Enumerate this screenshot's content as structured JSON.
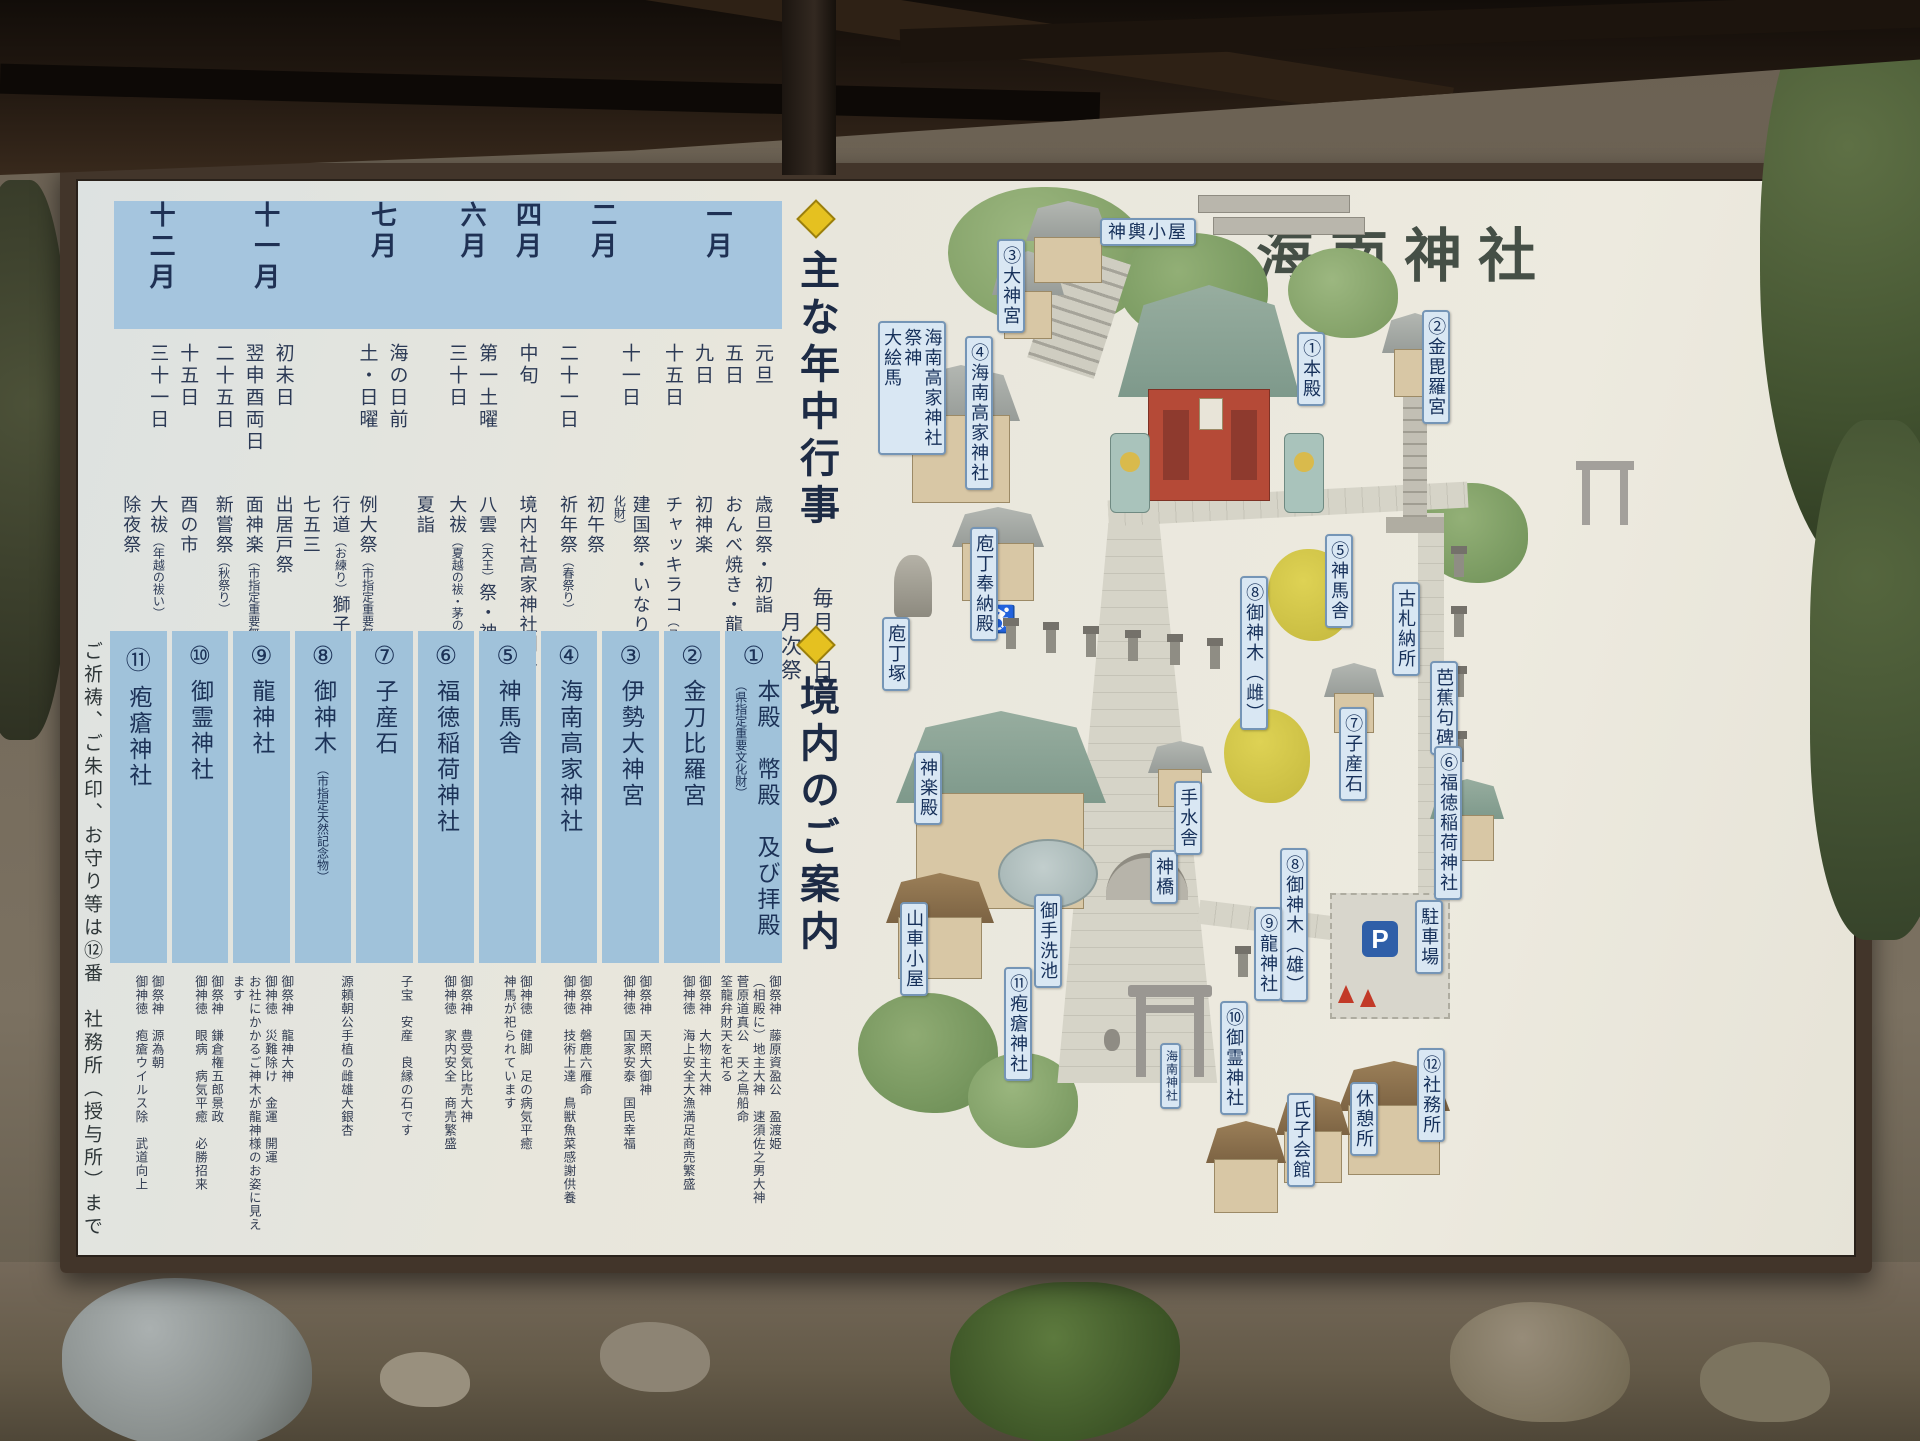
{
  "board": {
    "title": "海南神社",
    "events_section": {
      "header": "主な年中行事",
      "subheader": "毎月一日\n　月次祭",
      "months": [
        {
          "month": "一月",
          "entries": [
            {
              "date": "元旦",
              "event": "歳旦祭・初詣"
            },
            {
              "date": "五日",
              "event": "おんべ焼き・龍宮祭"
            },
            {
              "date": "九日",
              "event": "初神楽"
            },
            {
              "date": "十五日",
              "event": "チャッキラコ（ユネスコ無形文化遺産）"
            }
          ]
        },
        {
          "month": "二月",
          "entries": [
            {
              "date": "十一日",
              "event": "建国祭・いなりっこ（市指定重要無形民俗文化財）"
            },
            {
              "date": "",
              "event": "初午祭"
            },
            {
              "date": "二十一日",
              "event": "祈年祭（春祭り）"
            }
          ]
        },
        {
          "month": "四月",
          "entries": [
            {
              "date": "中旬",
              "event": "境内社高家神社例祭（食の神祭典・庖丁式）"
            }
          ]
        },
        {
          "month": "六月",
          "entries": [
            {
              "date": "第一土曜",
              "event": "八雲（天王）祭・神輿渡御"
            },
            {
              "date": "三十日",
              "event": "大祓（夏越の祓・茅の輪くぐり）"
            }
          ]
        },
        {
          "month": "七月",
          "entries": [
            {
              "date": "",
              "event": "夏詣"
            },
            {
              "date": "海の日前",
              "event": ""
            },
            {
              "date": "土・日曜",
              "event": "例大祭（市指定重要無形民俗文化財）"
            },
            {
              "date": "",
              "event": "行道（お練り）獅子・神輿渡御"
            }
          ]
        },
        {
          "month": "十一月",
          "entries": [
            {
              "date": "",
              "event": "七五三"
            },
            {
              "date": "初未日",
              "event": "出居戸祭"
            },
            {
              "date": "翌申酉両日",
              "event": "面神楽（市指定重要無形民俗文化財）"
            },
            {
              "date": "二十五日",
              "event": "新嘗祭（秋祭り）"
            }
          ]
        },
        {
          "month": "十二月",
          "entries": [
            {
              "date": "十五日",
              "event": "酉の市"
            },
            {
              "date": "三十一日",
              "event": "大祓（年越の祓い）"
            },
            {
              "date": "",
              "event": "除夜祭"
            }
          ]
        }
      ]
    },
    "guide_section": {
      "header": "境内のご案内",
      "spots": [
        {
          "no": "①",
          "name": "本殿　幣殿　及び拝殿",
          "note": "（県指定重要文化財）",
          "desc": "御祭神　藤原資盈公　盈渡姫\n（相殿に）地主大神　速須佐之男大神\n菅原道真公　天之鳥船命\n筌龍弁財天を祀る"
        },
        {
          "no": "②",
          "name": "金刀比羅宮",
          "note": "",
          "desc": "御祭神　大物主大神\n御神徳　海上安全大漁満足商売繁盛"
        },
        {
          "no": "③",
          "name": "伊勢大神宮",
          "note": "",
          "desc": "御祭神　天照大御神\n御神徳　国家安泰　国民幸福"
        },
        {
          "no": "④",
          "name": "海南高家神社",
          "note": "",
          "desc": "御祭神　磐鹿六雁命\n御神徳　技術上達　鳥獣魚菜感謝供養"
        },
        {
          "no": "⑤",
          "name": "神馬舎",
          "note": "",
          "desc": "御神徳　健脚　足の病気平癒\n神馬が祀られています"
        },
        {
          "no": "⑥",
          "name": "福徳稲荷神社",
          "note": "",
          "desc": "御祭神　豊受気比売大神\n御神徳　家内安全　商売繁盛"
        },
        {
          "no": "⑦",
          "name": "子産石",
          "note": "",
          "desc": "子宝　安産　良縁の石です"
        },
        {
          "no": "⑧",
          "name": "御神木",
          "note": "（市指定天然記念物）",
          "desc": "源頼朝公手植の雌雄大銀杏"
        },
        {
          "no": "⑨",
          "name": "龍神社",
          "note": "",
          "desc": "御祭神　龍神大神\n御神徳　災難除け　金運　開運\nお社にかかるご神木が龍神様のお姿に見えます"
        },
        {
          "no": "⑩",
          "name": "御霊神社",
          "note": "",
          "desc": "御祭神　鎌倉権五郎景政\n御神徳　眼病　病気平癒　必勝招来"
        },
        {
          "no": "⑪",
          "name": "疱瘡神社",
          "note": "",
          "desc": "御祭神　源為朝\n御神徳　疱瘡ウイルス除　武道向上"
        }
      ],
      "footnote": "ご祈祷、ご朱印、お守り等は⑫番　社務所（授与所）まで"
    },
    "map": {
      "parking_label": "P",
      "icons": {
        "wheelchair": "♿"
      },
      "labels": [
        {
          "t": "神輿小屋",
          "x": 282,
          "y": 25,
          "dir": "h"
        },
        {
          "t": "③大神宮",
          "x": 179,
          "y": 46
        },
        {
          "t": "④海南高家神社",
          "x": 147,
          "y": 143
        },
        {
          "t": "海南高家神社\n祭神\n大絵馬",
          "x": 60,
          "y": 128
        },
        {
          "t": "庖丁奉納殿",
          "x": 152,
          "y": 334
        },
        {
          "t": "庖丁塚",
          "x": 64,
          "y": 424
        },
        {
          "t": "①本殿",
          "x": 479,
          "y": 139
        },
        {
          "t": "②金毘羅宮",
          "x": 604,
          "y": 117
        },
        {
          "t": "⑤神馬舎",
          "x": 507,
          "y": 341
        },
        {
          "t": "古札納所",
          "x": 574,
          "y": 389
        },
        {
          "t": "芭蕉句碑",
          "x": 612,
          "y": 468
        },
        {
          "t": "⑧御神木（雌）",
          "x": 422,
          "y": 383
        },
        {
          "t": "⑦子産石",
          "x": 521,
          "y": 514
        },
        {
          "t": "⑥福徳稲荷神社",
          "x": 616,
          "y": 553
        },
        {
          "t": "⑧御神木（雄）",
          "x": 462,
          "y": 655
        },
        {
          "t": "⑨龍神社",
          "x": 436,
          "y": 714
        },
        {
          "t": "神楽殿",
          "x": 96,
          "y": 558
        },
        {
          "t": "山車小屋",
          "x": 82,
          "y": 709
        },
        {
          "t": "御手洗池",
          "x": 216,
          "y": 701
        },
        {
          "t": "神橋",
          "x": 332,
          "y": 657
        },
        {
          "t": "手水舎",
          "x": 356,
          "y": 588
        },
        {
          "t": "⑩御霊神社",
          "x": 402,
          "y": 808
        },
        {
          "t": "⑪疱瘡神社",
          "x": 186,
          "y": 774
        },
        {
          "t": "海南神社",
          "x": 342,
          "y": 850,
          "small": true
        },
        {
          "t": "氏子会館",
          "x": 469,
          "y": 900
        },
        {
          "t": "休憩所",
          "x": 532,
          "y": 889
        },
        {
          "t": "⑫社務所",
          "x": 599,
          "y": 855
        },
        {
          "t": "駐車場",
          "x": 597,
          "y": 707
        }
      ]
    }
  }
}
